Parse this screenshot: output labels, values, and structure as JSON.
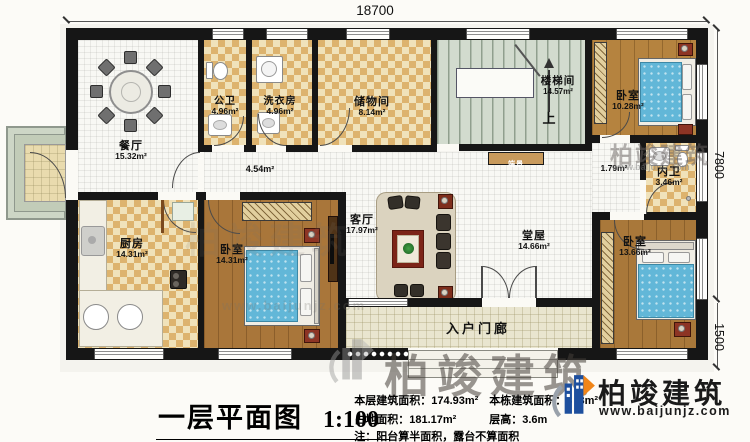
{
  "dimensions": {
    "top_width": "18700",
    "right_height": "7800",
    "right_porch_height": "1500"
  },
  "rooms": [
    {
      "id": "dining",
      "name": "餐厅",
      "area": "15.32m²"
    },
    {
      "id": "public-bath",
      "name": "公卫",
      "area": "4.96m²"
    },
    {
      "id": "laundry",
      "name": "洗衣房",
      "area": "4.96m²"
    },
    {
      "id": "storage",
      "name": "储物间",
      "area": "8.14m²"
    },
    {
      "id": "stairwell",
      "name": "楼梯间",
      "area": "14.57m²"
    },
    {
      "id": "bedroom-top-right",
      "name": "卧室",
      "area": "10.28m²"
    },
    {
      "id": "corridor",
      "name": "",
      "area": "4.54m²"
    },
    {
      "id": "hall-nook",
      "name": "",
      "area": "1.79m²"
    },
    {
      "id": "inner-bath",
      "name": "内卫",
      "area": "3.46m²"
    },
    {
      "id": "kitchen",
      "name": "厨房",
      "area": "14.31m²"
    },
    {
      "id": "bedroom-mid",
      "name": "卧室",
      "area": "14.31m²"
    },
    {
      "id": "living",
      "name": "客厅",
      "area": "17.97m²"
    },
    {
      "id": "main-hall",
      "name": "堂屋",
      "area": "14.66m²"
    },
    {
      "id": "bedroom-bottom-right",
      "name": "卧室",
      "area": "13.66m²"
    },
    {
      "id": "entry-porch",
      "name": "入户门廊",
      "area": ""
    }
  ],
  "annotations": {
    "stair_up": "上",
    "console_table": "端景"
  },
  "footer": {
    "plan_title": "一层平面图",
    "plan_scale": "1:100",
    "stats": {
      "floor_area_label": "本层建筑面积：",
      "floor_area_value": "174.93m²",
      "building_area_label": "本栋建筑面积：",
      "building_area_value": "3  3m²",
      "site_area_label": "占地面积：",
      "site_area_value": "181.17m²",
      "story_height_label": "层高：",
      "story_height_value": "3.6m",
      "note": "注：阳台算半面积，露台不算面积"
    },
    "logo": {
      "brand": "柏竣建筑",
      "website": "www.baijunjz.com"
    }
  },
  "watermark": {
    "brand": "柏竣建筑",
    "website": "www.baijunjz.com"
  },
  "colors": {
    "wall": "#161616",
    "checker_dark": "#ddb36e",
    "checker_light": "#f0e2ba",
    "wood": "#ad7a38",
    "bed_blue": "#62b7d8",
    "stair": "#d2dbce",
    "logo_blue": "#1d4f9e",
    "logo_orange": "#f08519"
  }
}
